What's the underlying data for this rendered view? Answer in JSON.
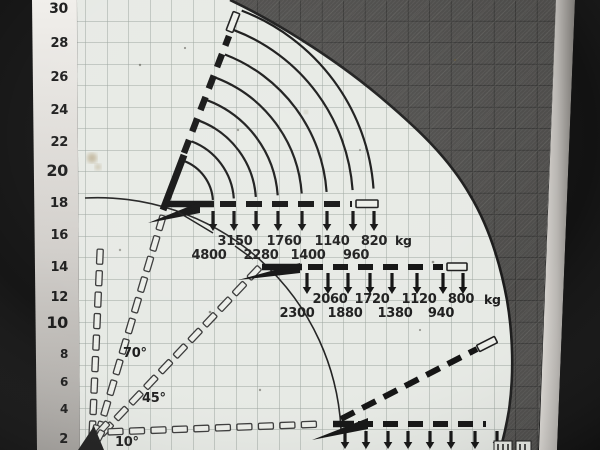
{
  "y_axis": {
    "values": [
      "30",
      "28",
      "26",
      "24",
      "22",
      "20",
      "18",
      "16",
      "14",
      "12",
      "10",
      "8",
      "6",
      "4",
      "2"
    ]
  },
  "angle_labels": {
    "a70": "70°",
    "a45": "45°",
    "a10": "10°"
  },
  "load_groups": [
    {
      "id": "jib-loads-at-70deg-boom",
      "upper_row": [
        "3150",
        "1760",
        "1140",
        "820"
      ],
      "lower_row": [
        "4800",
        "2280",
        "1400",
        "960"
      ],
      "unit": "kg"
    },
    {
      "id": "jib-loads-at-45deg-boom",
      "upper_row": [
        "2060",
        "1720",
        "1120",
        "800"
      ],
      "lower_row": [
        "2300",
        "1880",
        "1380",
        "940"
      ],
      "unit": "kg"
    },
    {
      "id": "jib-loads-at-10deg-boom",
      "upper_row": [],
      "lower_row": [],
      "unit": ""
    }
  ],
  "chart_data": {
    "type": "diagram",
    "title": "",
    "description_visible_text_only": "",
    "y_axis_values": [
      30,
      28,
      26,
      24,
      22,
      20,
      18,
      16,
      14,
      12,
      10,
      8,
      6,
      4,
      2
    ],
    "boom_angle_labels_deg": [
      70,
      45,
      10
    ],
    "capacity_series": [
      {
        "boom_angle": "70°",
        "unit": "kg",
        "capacities_outward": [
          4800,
          3150,
          2280,
          1760,
          1400,
          1140,
          960,
          820
        ]
      },
      {
        "boom_angle": "45°",
        "unit": "kg",
        "capacities_outward": [
          2300,
          2060,
          1880,
          1720,
          1380,
          1120,
          940,
          800
        ]
      },
      {
        "boom_angle": "10°",
        "unit": "kg",
        "capacities_outward": []
      }
    ]
  }
}
